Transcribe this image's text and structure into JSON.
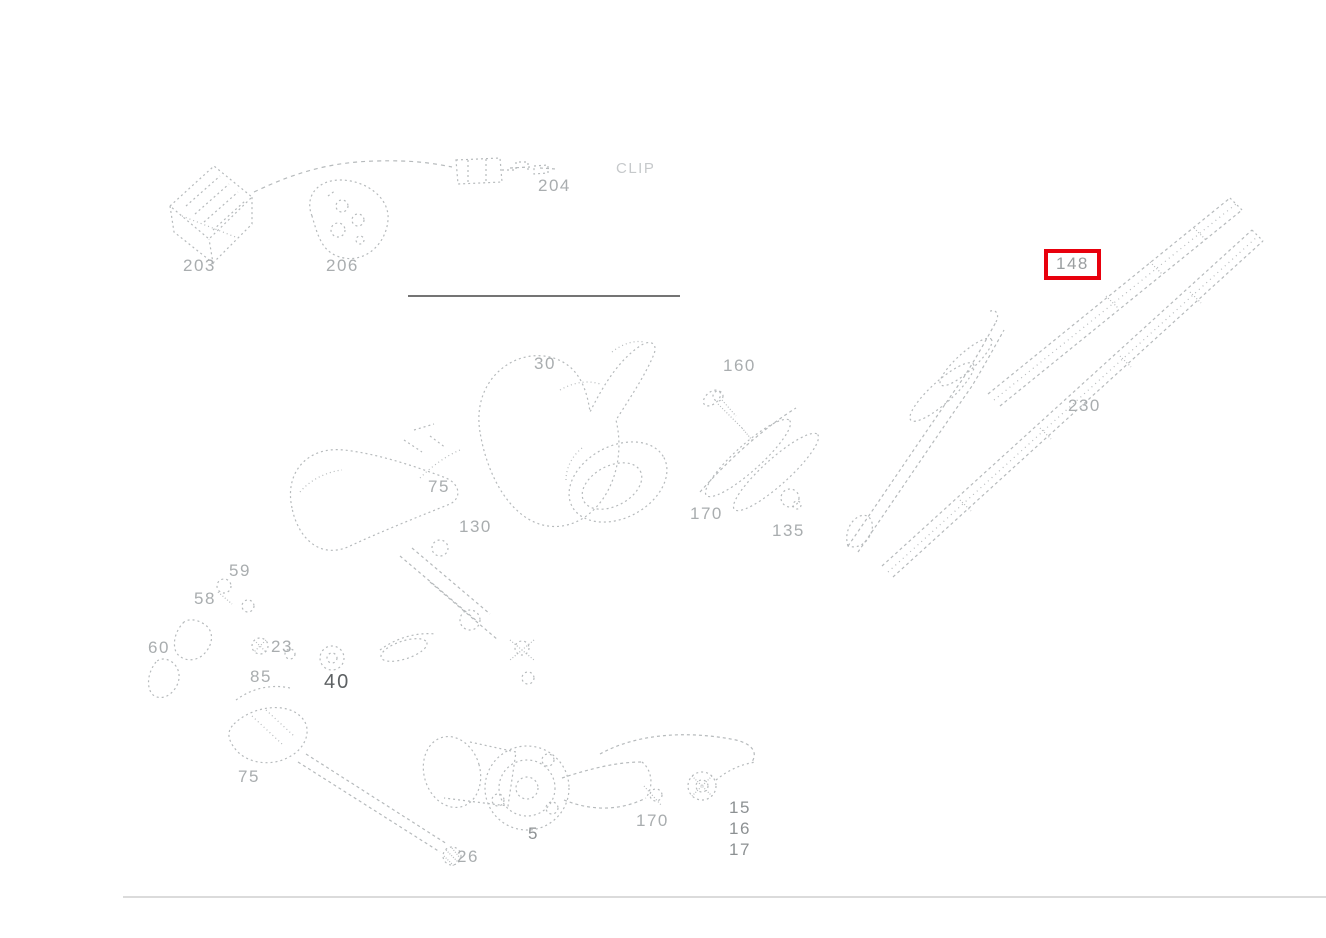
{
  "page": {
    "width": 1326,
    "height": 938,
    "background": "#ffffff",
    "kind": "exploded-parts-diagram",
    "description": "Windshield wiper system exploded parts diagram with one part callout highlighted"
  },
  "diagram": {
    "highlight": {
      "part": "148",
      "box_color": "#e8000d"
    },
    "colors": {
      "line_light": "#b6babc",
      "line_mid": "#9da2a4",
      "label_light": "#a9adaf",
      "label_mid": "#8d9193",
      "label_dark": "#5d6163",
      "divider": "#474747",
      "page_border": "#cfcfcf",
      "highlight_red": "#e8000d"
    },
    "labels": [
      {
        "id": "203",
        "text": "203",
        "x": 183,
        "y": 256,
        "tone": "light",
        "highlighted": false
      },
      {
        "id": "206",
        "text": "206",
        "x": 326,
        "y": 256,
        "tone": "light",
        "highlighted": false
      },
      {
        "id": "204",
        "text": "204",
        "x": 538,
        "y": 176,
        "tone": "light",
        "highlighted": false
      },
      {
        "id": "clip",
        "text": "CLIP",
        "x": 616,
        "y": 160,
        "tone": "faint",
        "highlighted": false
      },
      {
        "id": "148",
        "text": "148",
        "x": 1056,
        "y": 256,
        "tone": "light",
        "highlighted": true
      },
      {
        "id": "230",
        "text": "230",
        "x": 1068,
        "y": 396,
        "tone": "light",
        "highlighted": false
      },
      {
        "id": "30",
        "text": "30",
        "x": 534,
        "y": 354,
        "tone": "light",
        "highlighted": false
      },
      {
        "id": "160",
        "text": "160",
        "x": 723,
        "y": 356,
        "tone": "light",
        "highlighted": false
      },
      {
        "id": "75a",
        "text": "75",
        "x": 428,
        "y": 477,
        "tone": "light",
        "highlighted": false
      },
      {
        "id": "130",
        "text": "130",
        "x": 459,
        "y": 517,
        "tone": "light",
        "highlighted": false
      },
      {
        "id": "170a",
        "text": "170",
        "x": 690,
        "y": 504,
        "tone": "light",
        "highlighted": false
      },
      {
        "id": "135",
        "text": "135",
        "x": 772,
        "y": 521,
        "tone": "light",
        "highlighted": false
      },
      {
        "id": "59",
        "text": "59",
        "x": 229,
        "y": 561,
        "tone": "light",
        "highlighted": false
      },
      {
        "id": "58",
        "text": "58",
        "x": 194,
        "y": 589,
        "tone": "light",
        "highlighted": false
      },
      {
        "id": "60",
        "text": "60",
        "x": 148,
        "y": 638,
        "tone": "light",
        "highlighted": false
      },
      {
        "id": "23",
        "text": "23",
        "x": 271,
        "y": 637,
        "tone": "light",
        "highlighted": false
      },
      {
        "id": "85",
        "text": "85",
        "x": 250,
        "y": 667,
        "tone": "light",
        "highlighted": false
      },
      {
        "id": "40",
        "text": "40",
        "x": 324,
        "y": 671,
        "tone": "dark",
        "highlighted": false
      },
      {
        "id": "75b",
        "text": "75",
        "x": 238,
        "y": 767,
        "tone": "light",
        "highlighted": false
      },
      {
        "id": "26",
        "text": "26",
        "x": 457,
        "y": 847,
        "tone": "light",
        "highlighted": false
      },
      {
        "id": "5",
        "text": "5",
        "x": 528,
        "y": 824,
        "tone": "mid",
        "highlighted": false
      },
      {
        "id": "170b",
        "text": "170",
        "x": 636,
        "y": 811,
        "tone": "light",
        "highlighted": false
      },
      {
        "id": "15",
        "text": "15",
        "x": 729,
        "y": 798,
        "tone": "mid",
        "highlighted": false
      },
      {
        "id": "16",
        "text": "16",
        "x": 729,
        "y": 819,
        "tone": "mid",
        "highlighted": false
      },
      {
        "id": "17",
        "text": "17",
        "x": 729,
        "y": 840,
        "tone": "mid",
        "highlighted": false
      }
    ],
    "divider_line": {
      "x1": 408,
      "y1": 296,
      "x2": 680,
      "y2": 296
    },
    "bottom_border": {
      "x1": 123,
      "y1": 897,
      "x2": 1326,
      "y2": 897
    }
  }
}
